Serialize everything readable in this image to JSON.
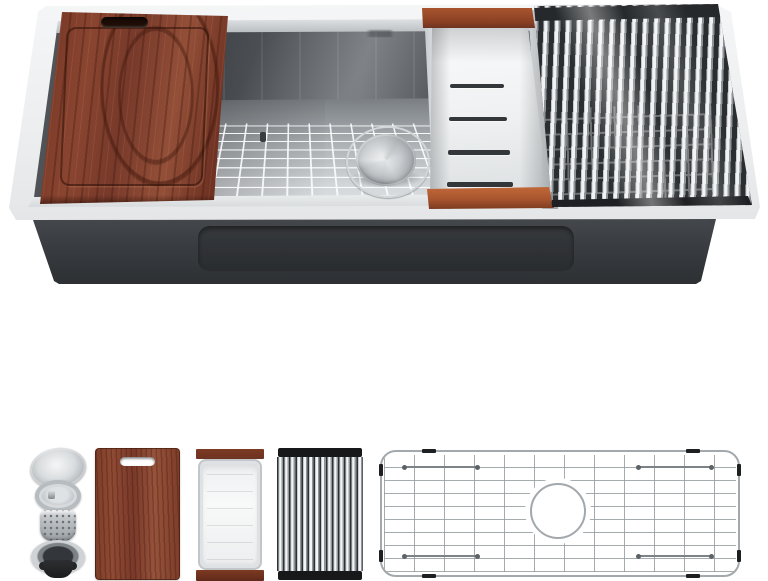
{
  "photo": {
    "subject": "stainless-steel workstation kitchen sink, angled top-front product shot",
    "background": "#ffffff"
  },
  "colors": {
    "white": "#ffffff",
    "rim": "#eff1f2",
    "bowl_dark": "#3f4347",
    "steel_light": "#e3e5e7",
    "wood": "#713324",
    "wood_accent": "#a8552e",
    "base": "#34373b",
    "mat_gap": "#2b2e31",
    "grid_line": "#a3a8ac",
    "black_cap": "#161819"
  },
  "sink": {
    "installed_parts": [
      "cutting-board",
      "workstation-ledge-track",
      "bottom-grid",
      "drain-basket",
      "colander-tray",
      "roll-up-drying-rack",
      "insulated-undercoat-base"
    ],
    "brand_mark": "small-etched-script-logo-illegible"
  },
  "accessory_row": {
    "items": [
      {
        "name": "drain-strainer-assembly"
      },
      {
        "name": "cutting-board"
      },
      {
        "name": "colander-tray"
      },
      {
        "name": "roll-up-drying-rack"
      },
      {
        "name": "bottom-grid"
      }
    ]
  }
}
